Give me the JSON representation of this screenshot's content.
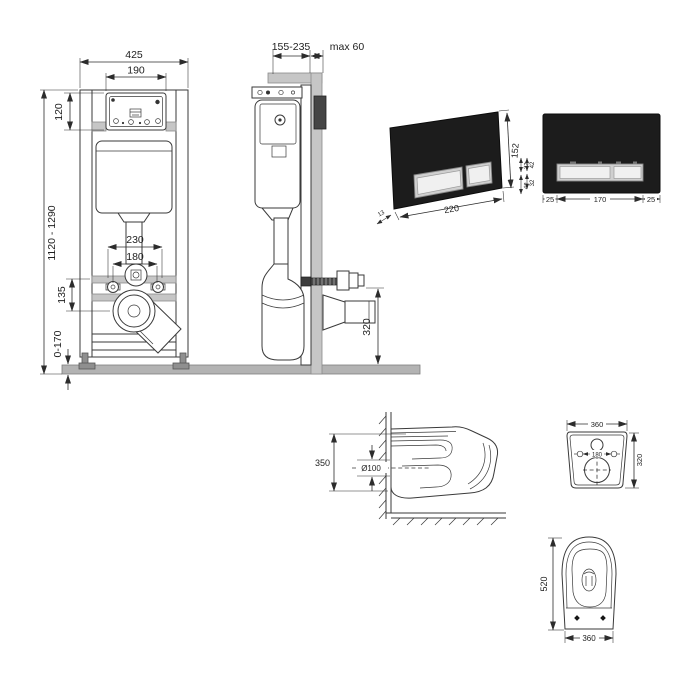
{
  "front_view": {
    "overall_width": "425",
    "panel_width": "190",
    "panel_height": "120",
    "height_range": "1120 - 1290",
    "supply_spacing": "230",
    "bolt_spacing": "180",
    "drain_drop": "135",
    "foot_adjust": "0-170"
  },
  "side_view": {
    "depth_range": "155-235",
    "finish_max": "max 60",
    "outlet_height": "320"
  },
  "plate_angled": {
    "height": "152",
    "width": "220",
    "thickness": "13",
    "aux_upper": "32",
    "aux_lower": "42"
  },
  "plate_front": {
    "aux_upper": "42",
    "aux_lower": "32",
    "left_margin": "25",
    "buttons_width": "170",
    "right_margin": "25"
  },
  "bowl_side": {
    "height": "350",
    "outlet_diameter": "Ø100"
  },
  "bowl_back": {
    "width": "360",
    "bolt_spacing": "180",
    "height": "320"
  },
  "bowl_plan": {
    "depth": "520",
    "width": "360"
  }
}
